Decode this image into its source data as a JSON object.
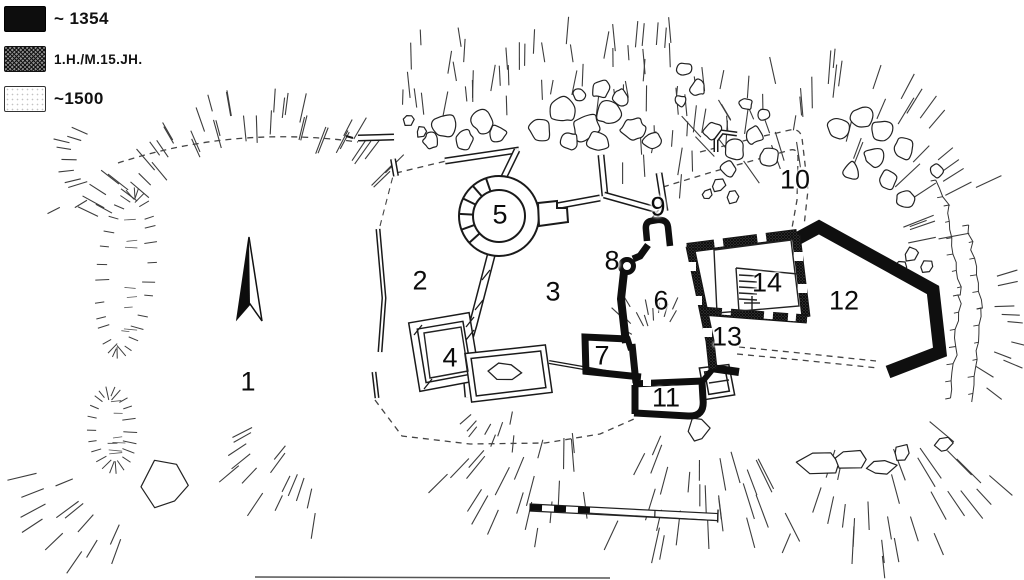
{
  "colors": {
    "ink": "#151515",
    "paper": "#ffffff"
  },
  "legend": {
    "items": [
      {
        "id": "phase-1354",
        "label": "~ 1354",
        "style": "solid-black"
      },
      {
        "id": "phase-15th-century",
        "label": "1.H./M.15.JH.",
        "style": "crosshatch"
      },
      {
        "id": "phase-1500",
        "label": "~1500",
        "style": "outline-white"
      }
    ]
  },
  "plan": {
    "area_labels": [
      {
        "text": "1"
      },
      {
        "text": "2"
      },
      {
        "text": "3"
      },
      {
        "text": "4"
      },
      {
        "text": "5"
      },
      {
        "text": "6"
      },
      {
        "text": "7"
      },
      {
        "text": "8"
      },
      {
        "text": "9"
      },
      {
        "text": "10"
      },
      {
        "text": "11"
      },
      {
        "text": "12"
      },
      {
        "text": "13"
      },
      {
        "text": "14"
      }
    ]
  }
}
